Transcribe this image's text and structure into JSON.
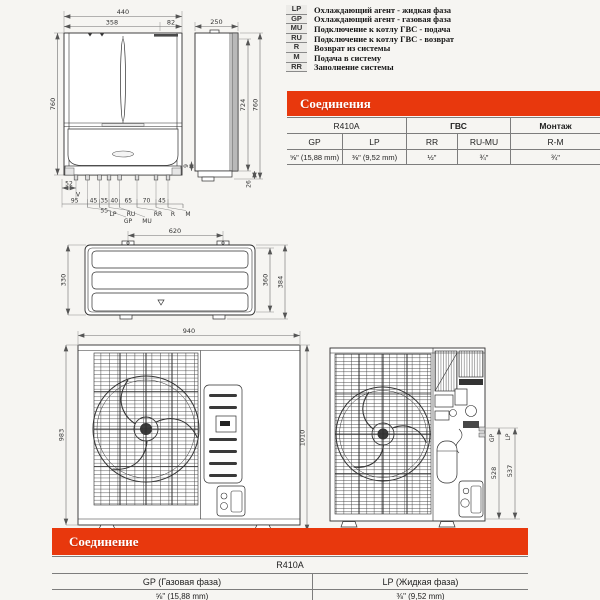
{
  "colors": {
    "accent": "#e8380d",
    "drawing_line": "#2e2e2e"
  },
  "legend": {
    "items": [
      {
        "abbr": "LP",
        "text": "Охлаждающий агент - жидкая фаза"
      },
      {
        "abbr": "GP",
        "text": "Охлаждающий агент - газовая фаза"
      },
      {
        "abbr": "MU",
        "text": "Подключение к котлу ГВС - подача"
      },
      {
        "abbr": "RU",
        "text": "Подключение к котлу ГВС - возврат"
      },
      {
        "abbr": "R",
        "text": "Возврат из системы"
      },
      {
        "abbr": "M",
        "text": "Подача в систему"
      },
      {
        "abbr": "RR",
        "text": "Заполнение системы"
      }
    ]
  },
  "table1": {
    "title": "Соединения",
    "groups": [
      "R410A",
      "ГВС",
      "Монтаж"
    ],
    "columns": [
      "GP",
      "LP",
      "RR",
      "RU-MU",
      "R-M"
    ],
    "values": [
      "⅝\" (15,88 mm)",
      "⅜\" (9,52 mm)",
      "½\"",
      "¾\"",
      "¾\""
    ]
  },
  "table2": {
    "title": "Соединение",
    "refrigerant": "R410A",
    "columns": [
      "GP (Газовая фаза)",
      "LP  (Жидкая фаза)"
    ],
    "values": [
      "⅝\" (15,88 mm)",
      "⅜\" (9,52 mm)"
    ]
  },
  "indoor": {
    "front": {
      "w": "440",
      "w1": "358",
      "w2": "82",
      "h": "760",
      "row": [
        "95",
        "45",
        "35",
        "40",
        "65",
        "70",
        "45"
      ],
      "sub": "55",
      "offset": "52",
      "vent": "V",
      "ports1": [
        "LP",
        "RU",
        "RR",
        "R",
        "M"
      ],
      "ports2": [
        "GP",
        "MU"
      ]
    },
    "side": {
      "w": "250",
      "h_inner": "724",
      "h_outer": "760",
      "d_small": "9",
      "d_bottom": "26"
    }
  },
  "outdoor_top": {
    "w": "620",
    "h": "330",
    "d_inner": "360",
    "d_outer": "384"
  },
  "outdoor_front": {
    "w": "940",
    "h_left": "983",
    "h_right": "1010"
  },
  "outdoor_internal": {
    "labels": [
      "GP",
      "LP"
    ],
    "h_gp": "528",
    "h_lp": "537"
  }
}
